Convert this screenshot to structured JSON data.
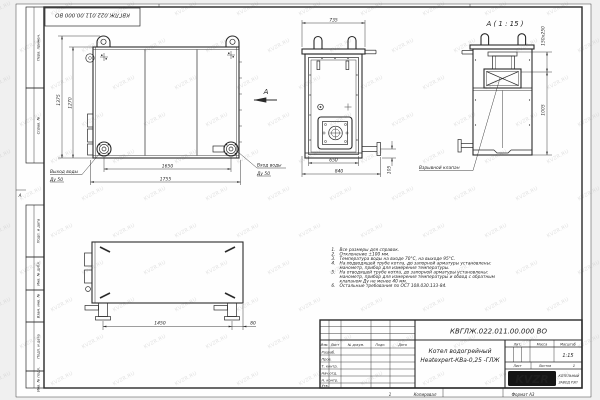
{
  "watermark": "KVZR.RU",
  "stamp_top": "КВГЛЖ.022.011.00.000 ВО",
  "margin_boxes": {
    "perv": "Перв. примен.",
    "sprav": "Справ. №",
    "podp1": "Подп. и дата",
    "inv_dubl": "Инв. № дубл.",
    "vzam": "Взам. инв. №",
    "podp2": "Подп. и дата",
    "inv_podl": "Инв. № подл.",
    "zone_a": "А"
  },
  "front_view": {
    "dim_height_total": "1375",
    "dim_height_inner": "1270",
    "dim_width_inner": "1650",
    "dim_width_total": "1755",
    "outlet_label": "Выход воды",
    "outlet_dn": "Ду 50",
    "inlet_label": "Вход воды",
    "inlet_dn": "Ду 50",
    "view_arrow": "А"
  },
  "side_view": {
    "dim_top": "735",
    "dim_inner": "650",
    "dim_total": "840",
    "dim_pipe": "105"
  },
  "detail_view": {
    "title": "А ( 1 : 15 )",
    "dim_valve": "150x250",
    "dim_height": "1005",
    "valve_label": "Взрывной клапан"
  },
  "plan_view": {
    "dim_length": "1450",
    "dim_offset": "80"
  },
  "notes": {
    "rows": [
      {
        "num": "1.",
        "text": "Все размеры для справок."
      },
      {
        "num": "2.",
        "text": "Отклонение ±100 мм."
      },
      {
        "num": "3.",
        "text": "Температура воды на входе 70°С, на выходе 95°С."
      },
      {
        "num": "4.",
        "text": "На подводящей трубе котла, до запорной арматуры установлены:"
      },
      {
        "num": "",
        "text": "манометр, прибор для измерения температуры."
      },
      {
        "num": "5.",
        "text": "На отводящей трубе котла, до запорной арматуры установлены:"
      },
      {
        "num": "",
        "text": "манометр, прибор для измерения температуры и обвод с обратным"
      },
      {
        "num": "",
        "text": "клапаном Ду не менее 40 мм."
      },
      {
        "num": "6.",
        "text": "Остальные требования по ОСТ 108.030.133-84."
      }
    ]
  },
  "title_block": {
    "designation": "КВГЛЖ.022.011.00.000 ВО",
    "product_line1": "Котел водогрейный",
    "product_line2": "Heatexpert-КВа-0,25 -ГЛЖ",
    "col_izm": "Изм.",
    "col_list": "Лист",
    "col_docnum": "№ докум.",
    "col_podp": "Подп.",
    "col_data": "Дата",
    "row_razrab": "Разраб.",
    "row_prov": "Пров.",
    "row_tkontr": "Т. контр.",
    "row_nachotd": "Нач.отд.",
    "row_nkontr": "Н. контр.",
    "row_utv": "Утв.",
    "lit_label": "Лит.",
    "massa_label": "Масса",
    "masshtab_label": "Масштаб",
    "scale_value": "1:15",
    "list_label": "Лист",
    "listov_label": "Листов",
    "listov_value": "1",
    "logo_text": "KVZR",
    "logo_caption1": "КОТЕЛЬНЫЙ",
    "logo_caption2": "ЗАВОД РЭП",
    "footer_zone": "1",
    "footer_kopiroval": "Копировал",
    "footer_format": "Формат А3"
  },
  "colors": {
    "line": "#2a2a2a",
    "watermark": "#c9c9c9",
    "paper": "#fefefe"
  }
}
